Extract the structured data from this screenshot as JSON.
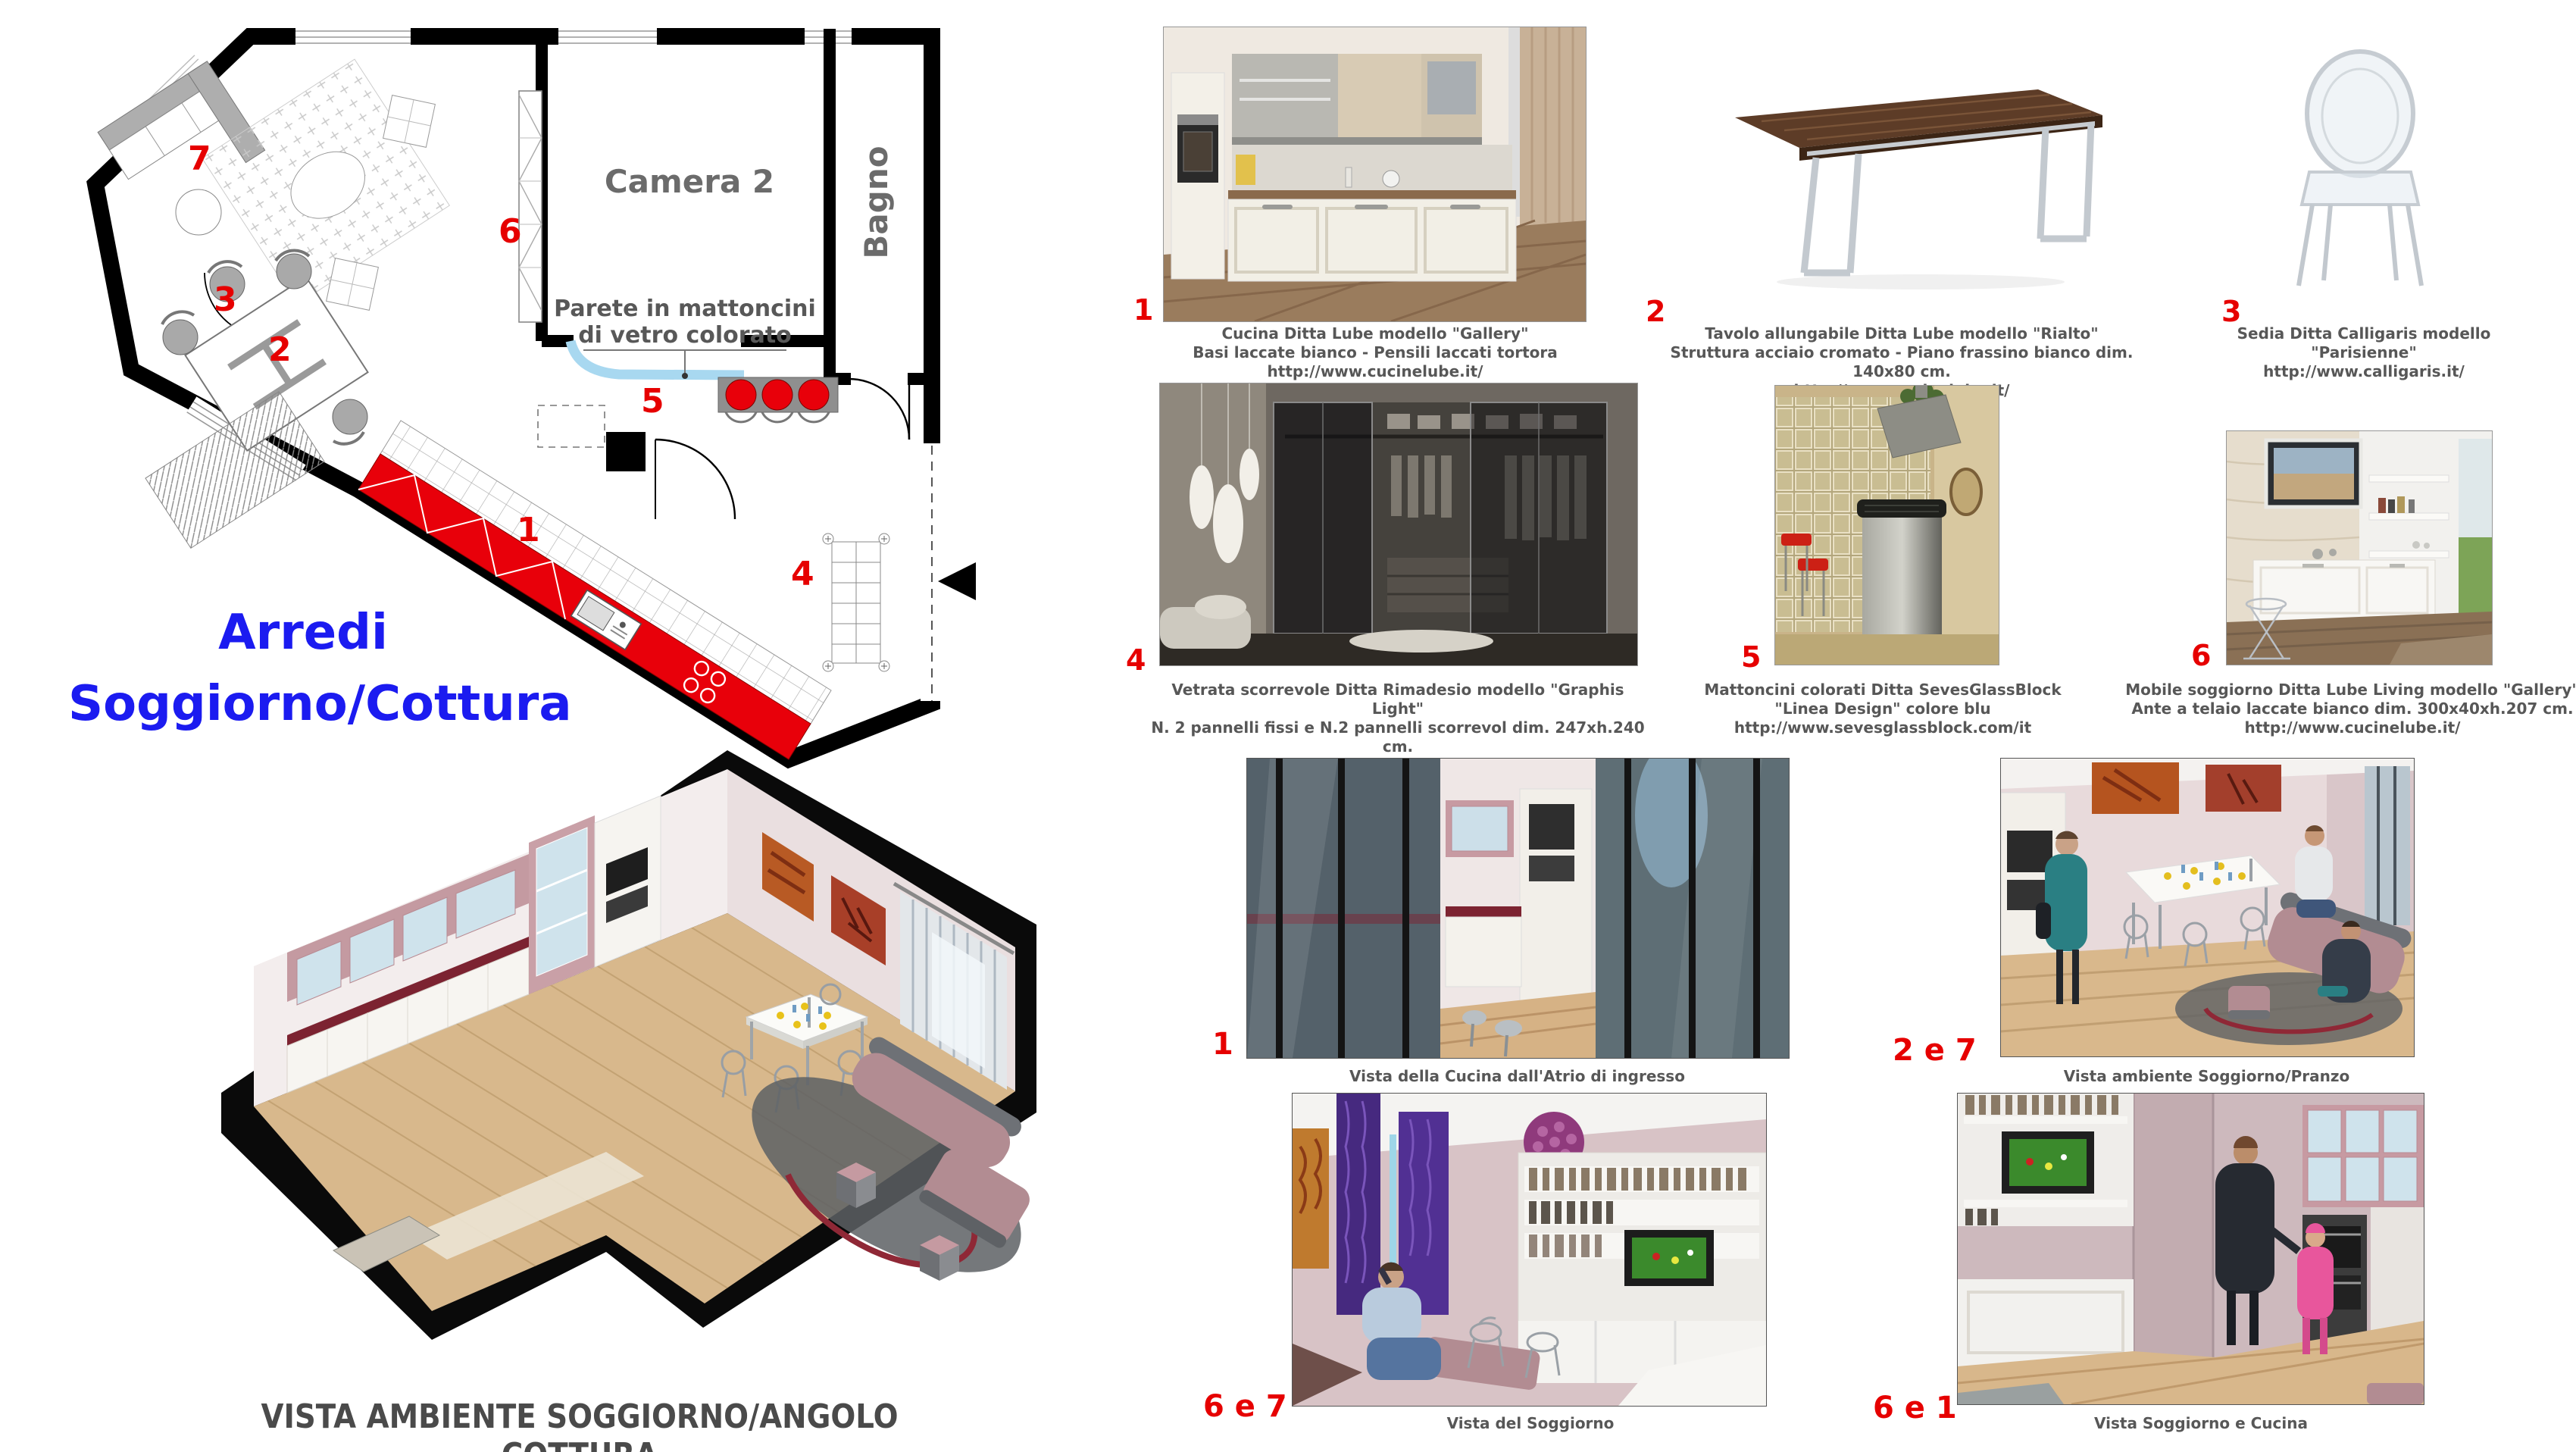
{
  "colors": {
    "accent_red": "#e60000",
    "title_blue": "#1b1bf0",
    "caption_gray": "#575757",
    "plan_glass_blue": "#a8d8f0",
    "kitchen_red": "#e8000a"
  },
  "floor_plan": {
    "labels": {
      "camera2": "Camera 2",
      "bagno": "Bagno",
      "wall_note_line1": "Parete in mattoncini",
      "wall_note_line2": "di vetro colorato"
    },
    "markers": {
      "m1": "1",
      "m2": "2",
      "m3": "3",
      "m4": "4",
      "m5": "5",
      "m6": "6",
      "m7": "7"
    },
    "title_line1": "Arredi",
    "title_line2": "Soggiorno/Cottura"
  },
  "iso_view": {
    "caption": "VISTA AMBIENTE SOGGIORNO/ANGOLO COTTURA"
  },
  "products": [
    {
      "num": "1",
      "lines": [
        "Cucina Ditta Lube modello \"Gallery\"",
        "Basi laccate bianco - Pensili laccati tortora",
        "http://www.cucinelube.it/"
      ]
    },
    {
      "num": "2",
      "lines": [
        "Tavolo allungabile Ditta Lube modello \"Rialto\"",
        "Struttura acciaio cromato - Piano frassino bianco dim. 140x80 cm.",
        "http://www.cucinelube.it/"
      ]
    },
    {
      "num": "3",
      "lines": [
        "Sedia Ditta Calligaris modello \"Parisienne\"",
        "http://www.calligaris.it/"
      ]
    },
    {
      "num": "4",
      "lines": [
        "Vetrata scorrevole Ditta Rimadesio modello \"Graphis Light\"",
        "N. 2 pannelli fissi e N.2 pannelli scorrevol dim. 247xh.240 cm.",
        "http://www.rimadesio.it/ita/"
      ]
    },
    {
      "num": "5",
      "lines": [
        "Mattoncini colorati Ditta SevesGlassBlock",
        "\"Linea Design\" colore blu",
        "http://www.sevesglassblock.com/it"
      ]
    },
    {
      "num": "6",
      "lines": [
        "Mobile soggiorno Ditta Lube Living modello \"Gallery\"",
        "Ante a telaio laccate bianco dim. 300x40xh.207 cm.",
        "http://www.cucinelube.it/"
      ]
    }
  ],
  "views": [
    {
      "num": "1",
      "caption": "Vista della Cucina dall'Atrio di ingresso"
    },
    {
      "num": "2 e 7",
      "caption": "Vista ambiente Soggiorno/Pranzo"
    },
    {
      "num": "6 e 7",
      "caption": "Vista del Soggiorno"
    },
    {
      "num": "6 e 1",
      "caption": "Vista Soggiorno e Cucina"
    }
  ]
}
